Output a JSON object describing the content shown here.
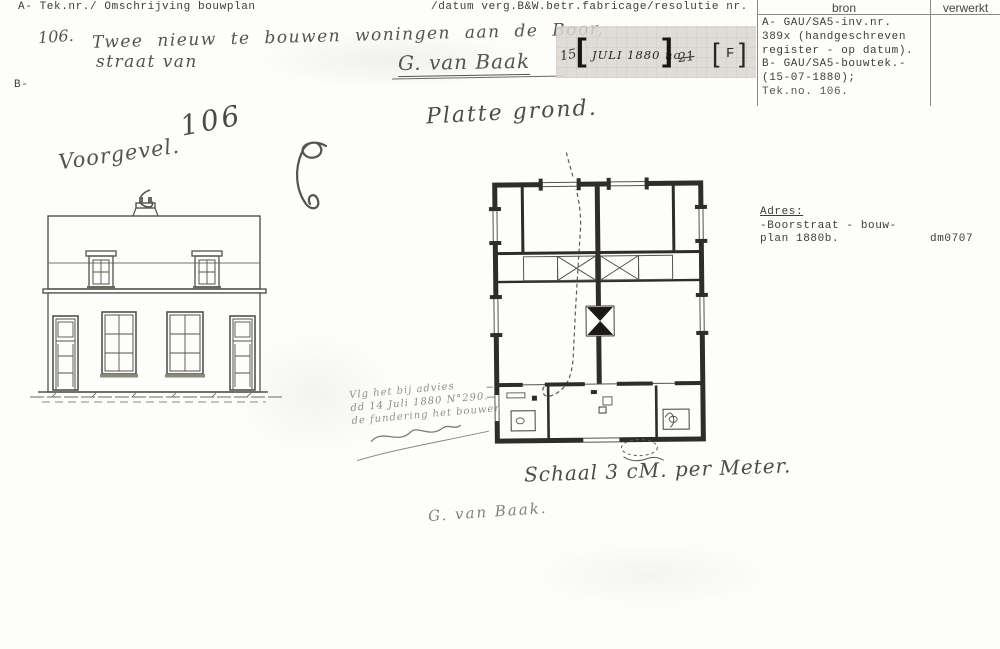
{
  "typed_header": {
    "left": "A- Tek.nr./ Omschrijving bouwplan",
    "right": "/datum verg.B&W.betr.fabricage/resolutie nr.",
    "bron_col": "bron",
    "verwerkt_col": "verwerkt"
  },
  "margin": {
    "b_label": "B-"
  },
  "bron_lines": [
    "A- GAU/SA5-inv.nr.",
    "389x (handgeschreven",
    "register - op datum).",
    "B- GAU/SA5-bouwtek.-",
    "(15-07-1880);",
    "Tek.no. 106."
  ],
  "adres": {
    "label": "Adres:",
    "line1": "-Boorstraat - bouw-",
    "line2": "plan 1880b.",
    "code": "dm0707"
  },
  "stamp": {
    "prefix": "15",
    "bracket_open": "[",
    "text": "JULI 1880 no",
    "bracket_close": "]",
    "suffix": "21",
    "letter_open": "[",
    "letter": "F",
    "letter_close": "]"
  },
  "handwriting": {
    "entry_no": "106.",
    "entry_line1": "Twee nieuw te bouwen woningen aan de Boor,",
    "entry_line2": "straat van",
    "architect": "G. van Baak",
    "big_number": "106",
    "voorgevel": "Voorgevel.",
    "plattegrond": "Platte grond.",
    "schaal": "Schaal 3 cM. per Meter.",
    "signature": "G. van Baak.",
    "note1": "Vlg het bij advies",
    "note2": "dd 14 Juli 1880 N°290.",
    "note3": "de fundering het bouwen"
  },
  "colors": {
    "paper": "#fdfdfb",
    "ink_typed": "#3d3c38",
    "ink_hand": "#55534c",
    "wall_fill": "#2f2d29",
    "stamp_panel": "#dcd8d2"
  }
}
